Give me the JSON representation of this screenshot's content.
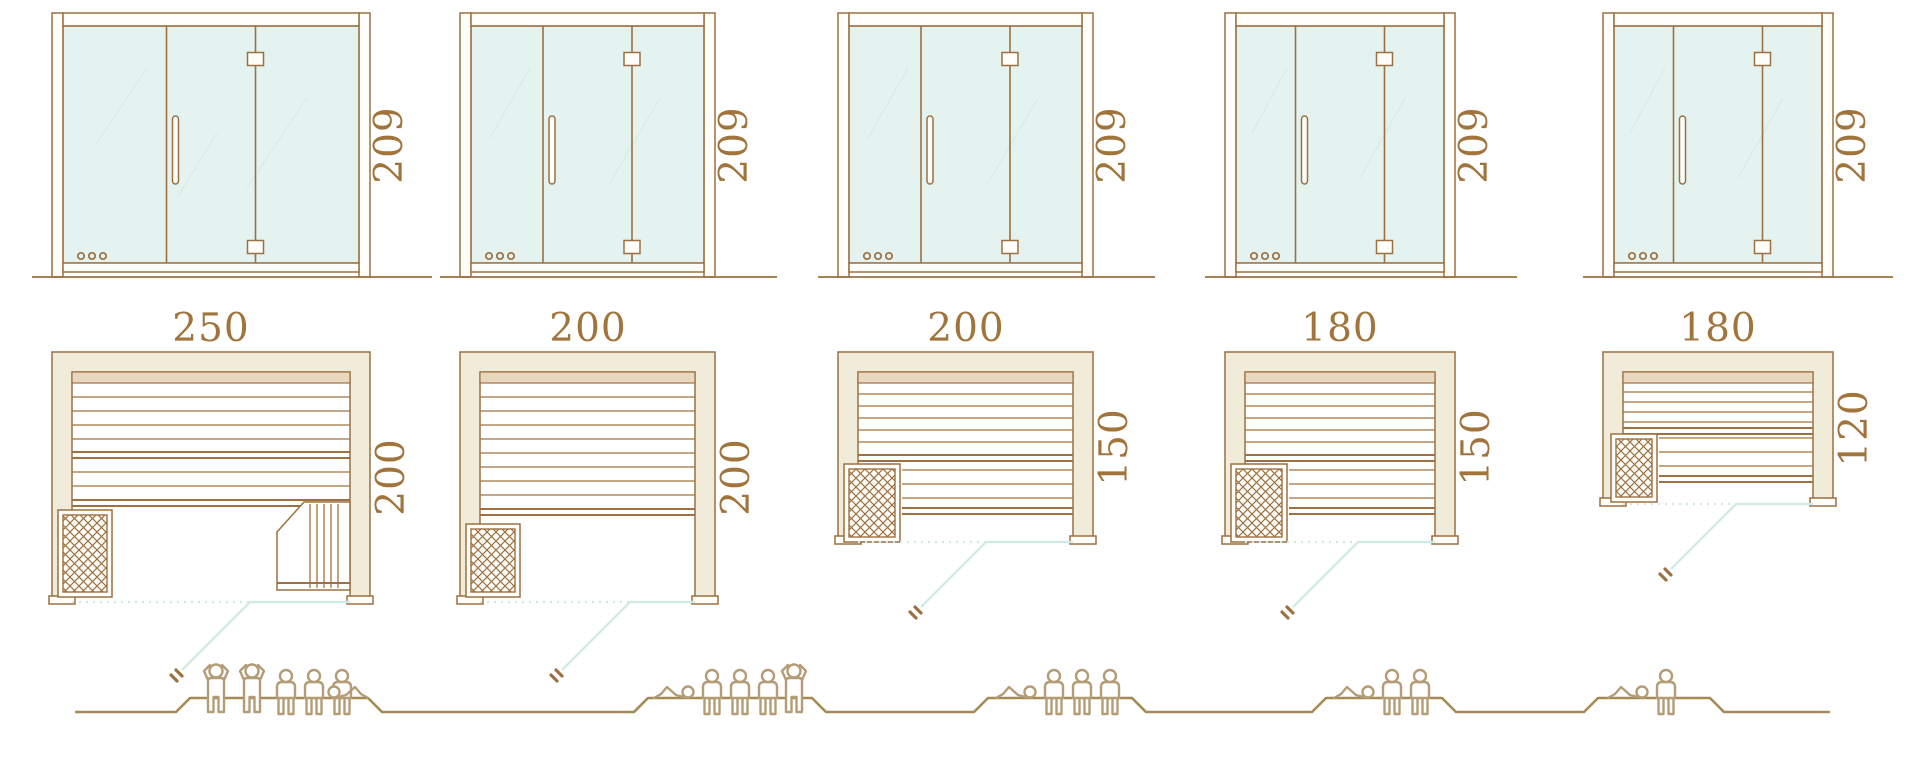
{
  "diagram": {
    "name": "sauna-size-comparison",
    "colors": {
      "line_brown": "#9c7040",
      "dimension_text": "#a1743c",
      "glass": "#e4f3ef",
      "wall_fill": "#f1ecda",
      "door_swing_teal": "#cfe9e3",
      "figure_outline": "#b49d76"
    },
    "models": [
      {
        "name": "sauna-250x200",
        "door_height": "209",
        "plan_width": "250",
        "plan_depth": "200",
        "capacity": {
          "standing": 2,
          "sitting": 3,
          "lying": 1,
          "total": 6
        }
      },
      {
        "name": "sauna-200x200",
        "door_height": "209",
        "plan_width": "200",
        "plan_depth": "200",
        "capacity": {
          "standing": 1,
          "sitting": 3,
          "lying": 1,
          "total": 5
        }
      },
      {
        "name": "sauna-200x150",
        "door_height": "209",
        "plan_width": "200",
        "plan_depth": "150",
        "capacity": {
          "standing": 0,
          "sitting": 3,
          "lying": 1,
          "total": 4
        }
      },
      {
        "name": "sauna-180x150",
        "door_height": "209",
        "plan_width": "180",
        "plan_depth": "150",
        "capacity": {
          "standing": 0,
          "sitting": 2,
          "lying": 1,
          "total": 3
        }
      },
      {
        "name": "sauna-180x120",
        "door_height": "209",
        "plan_width": "180",
        "plan_depth": "120",
        "capacity": {
          "standing": 0,
          "sitting": 1,
          "lying": 1,
          "total": 2
        }
      }
    ]
  }
}
